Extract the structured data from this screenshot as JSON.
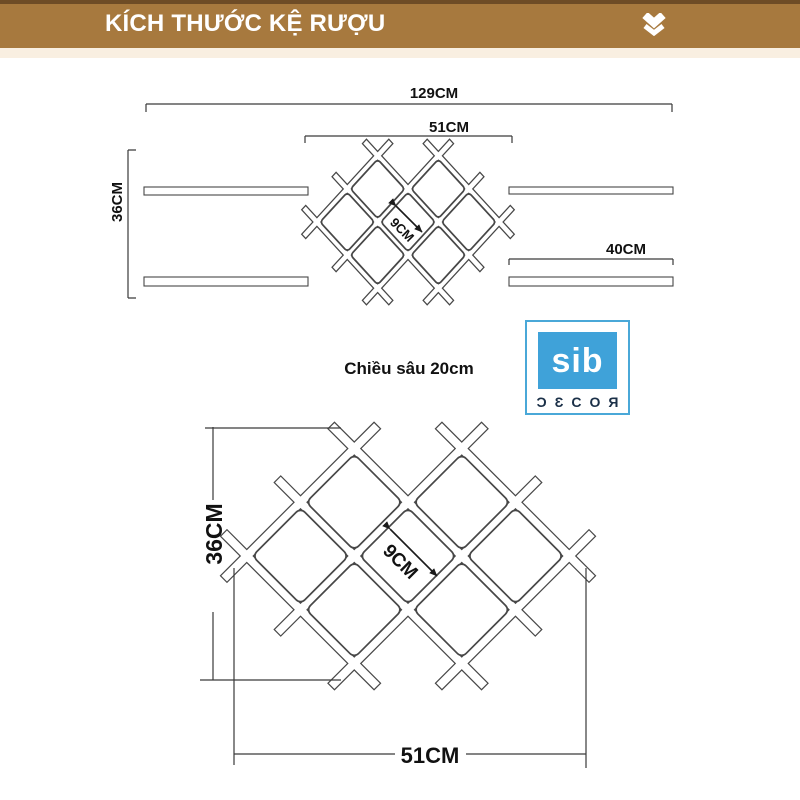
{
  "header": {
    "title": "KÍCH THƯỚC KỆ RƯỢU",
    "bar_color": "#a7793e",
    "bar_top_color": "#6e4c26",
    "bar_bottom_strip_color": "#f9efe1",
    "chevron_icon": "chevron-down-icon"
  },
  "top_view": {
    "overall_width": "129CM",
    "rack_width": "51CM",
    "height": "36CM",
    "shelf_width": "40CM",
    "cell_size": "9CM"
  },
  "depth_note": "Chiều sâu 20cm",
  "logo": {
    "name": "sib",
    "decor_text": "ƆƐCOЯ",
    "blue": "#3fa2d9",
    "border_blue": "#4aa8d8",
    "decor_color": "#1b3048"
  },
  "front_view": {
    "height": "36CM",
    "width": "51CM",
    "cell_size": "9CM"
  },
  "line_color": "#3a3a3a"
}
